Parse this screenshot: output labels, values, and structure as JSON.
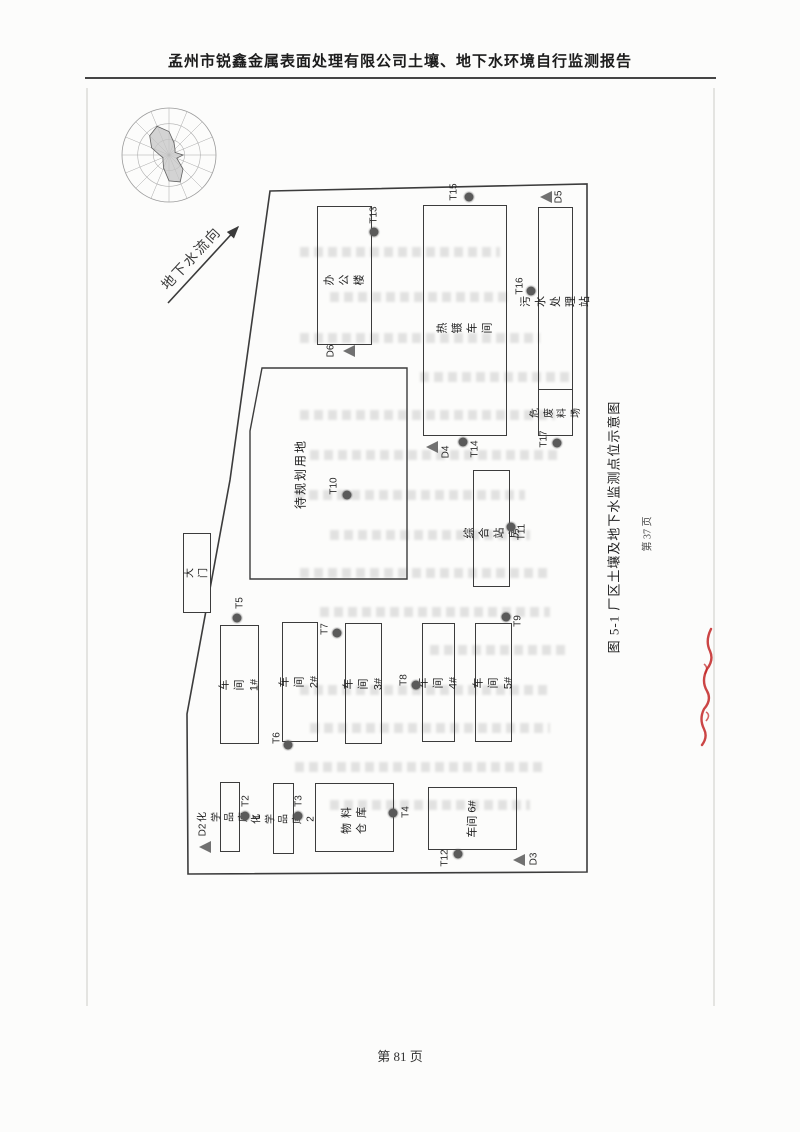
{
  "header": {
    "title": "孟州市锐鑫金属表面处理有限公司土壤、地下水环境自行监测报告"
  },
  "footer": {
    "page_label": "第 81 页"
  },
  "figure": {
    "caption": "图 5-1 厂区土壤及地下水监测点位示意图",
    "inner_page_label": "第 37 页",
    "flow_arrow_label": "地下水流向",
    "buildings": [
      {
        "key": "office",
        "label": "办 公 楼"
      },
      {
        "key": "hot-plating-workshop",
        "label": "热 镀 车 间"
      },
      {
        "key": "sewage-treatment-station",
        "label": "污水处理站"
      },
      {
        "key": "hazardous-waste-yard",
        "label": "危废\n料场"
      },
      {
        "key": "land-to-be-planned",
        "label": "待规划用地"
      },
      {
        "key": "comprehensive-station",
        "label": "综 合 站 房"
      },
      {
        "key": "workshop-1",
        "label": "车间 1#"
      },
      {
        "key": "workshop-2",
        "label": "车间 2#"
      },
      {
        "key": "workshop-3",
        "label": "车间 3#"
      },
      {
        "key": "workshop-4",
        "label": "车间 4#"
      },
      {
        "key": "workshop-5",
        "label": "车间 5#"
      },
      {
        "key": "chemical-storage-1",
        "label": "化学品库 1"
      },
      {
        "key": "chemical-storage-2",
        "label": "化学品库 2"
      },
      {
        "key": "material-warehouse",
        "label": "物料\n仓库"
      },
      {
        "key": "workshop-6",
        "label": "车间 6#"
      },
      {
        "key": "gate",
        "label": "大门"
      }
    ],
    "soil_points": [
      {
        "id": "T2"
      },
      {
        "id": "T3"
      },
      {
        "id": "T4"
      },
      {
        "id": "T5"
      },
      {
        "id": "T6"
      },
      {
        "id": "T7"
      },
      {
        "id": "T8"
      },
      {
        "id": "T9"
      },
      {
        "id": "T10"
      },
      {
        "id": "T11"
      },
      {
        "id": "T12"
      },
      {
        "id": "T13"
      },
      {
        "id": "T14"
      },
      {
        "id": "T15"
      },
      {
        "id": "T16"
      },
      {
        "id": "T17"
      }
    ],
    "well_points": [
      {
        "id": "D2"
      },
      {
        "id": "D3"
      },
      {
        "id": "D4"
      },
      {
        "id": "D5"
      },
      {
        "id": "D6"
      }
    ],
    "legend_colors": {
      "soil_point": "#5a5a5a",
      "well_point": "#717171",
      "outline": "#3c3c3c",
      "annotation_red": "#c22424"
    }
  },
  "chart_data": {
    "type": "radar",
    "title": "wind-rose (unlabeled, estimated from shading)",
    "categories": [
      "N",
      "NNE",
      "NE",
      "ENE",
      "E",
      "ESE",
      "SE",
      "SSE",
      "S",
      "SSW",
      "SW",
      "WSW",
      "W",
      "WNW",
      "NW",
      "NNW"
    ],
    "values": [
      0.5,
      0.28,
      0.18,
      0.14,
      0.3,
      0.18,
      0.42,
      0.62,
      0.55,
      0.3,
      0.18,
      0.14,
      0.2,
      0.4,
      0.58,
      0.66
    ],
    "ylim": [
      0,
      1
    ],
    "grid": "3 concentric rings, 16 spokes"
  }
}
